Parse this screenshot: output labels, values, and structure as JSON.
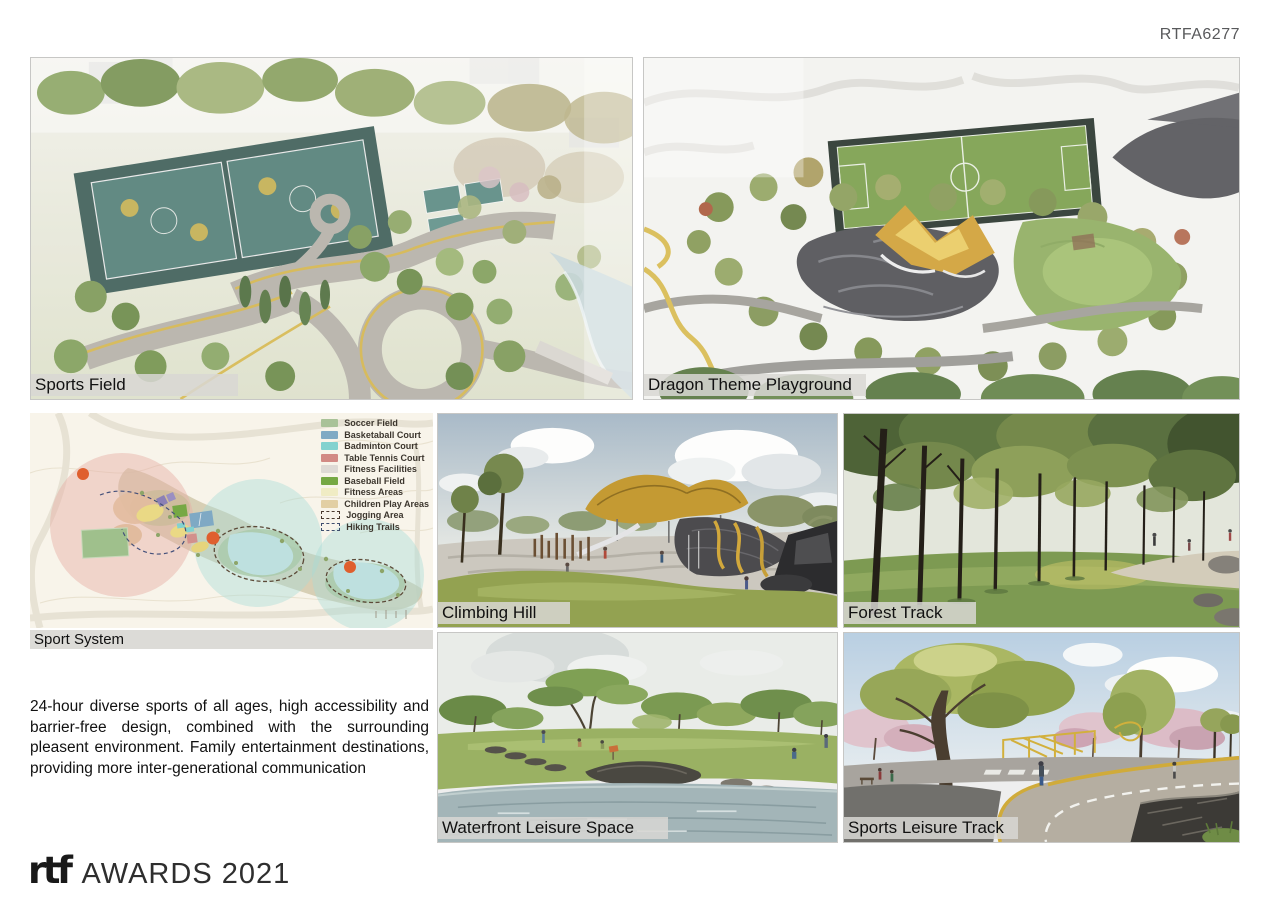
{
  "page": {
    "code": "RTFA6277"
  },
  "panels": {
    "sports_field": {
      "label": "Sports Field"
    },
    "dragon_playground": {
      "label": "Dragon Theme Playground"
    },
    "sport_system": {
      "label": "Sport System"
    },
    "climbing_hill": {
      "label": "Climbing Hill"
    },
    "forest_track": {
      "label": "Forest Track"
    },
    "waterfront": {
      "label": "Waterfront Leisure Space"
    },
    "leisure_track": {
      "label": "Sports Leisure Track"
    }
  },
  "map_legend": {
    "items": [
      {
        "label": "Soccer Field",
        "swatch": "#a9c298",
        "style": "fill"
      },
      {
        "label": "Basketaball Court",
        "swatch": "#80aac4",
        "style": "fill"
      },
      {
        "label": "Badminton Court",
        "swatch": "#82d2cf",
        "style": "fill"
      },
      {
        "label": "Table Tennis Court",
        "swatch": "#d28a85",
        "style": "fill"
      },
      {
        "label": "Fitness Facilities",
        "swatch": "#dedad5",
        "style": "fill"
      },
      {
        "label": "Baseball Field",
        "swatch": "#76a844",
        "style": "fill"
      },
      {
        "label": "Fitness Areas",
        "swatch": "#f0ecc4",
        "style": "fill"
      },
      {
        "label": "Children Play Areas",
        "swatch": "#e2cfa4",
        "style": "fill"
      },
      {
        "label": "Jogging Area",
        "swatch": "#4a3a2e",
        "style": "dashed"
      },
      {
        "label": "Hiking Trails",
        "swatch": "#3e4e6e",
        "style": "dashed"
      }
    ]
  },
  "description": "24-hour diverse sports of all ages, high accessibility and barrier-free design, combined with the surrounding pleasent environment. Family entertainment destinations, providing more inter-generational communication",
  "footer": {
    "logo_mark": "rtf",
    "logo_text": "AWARDS 2021"
  },
  "colors": {
    "label_bg": "#d8d7d3",
    "page_code_text": "#58595b",
    "map_bg": "#f8f4ea",
    "accent_orange": "#df5f2e",
    "accent_yellow": "#d2a83c"
  }
}
